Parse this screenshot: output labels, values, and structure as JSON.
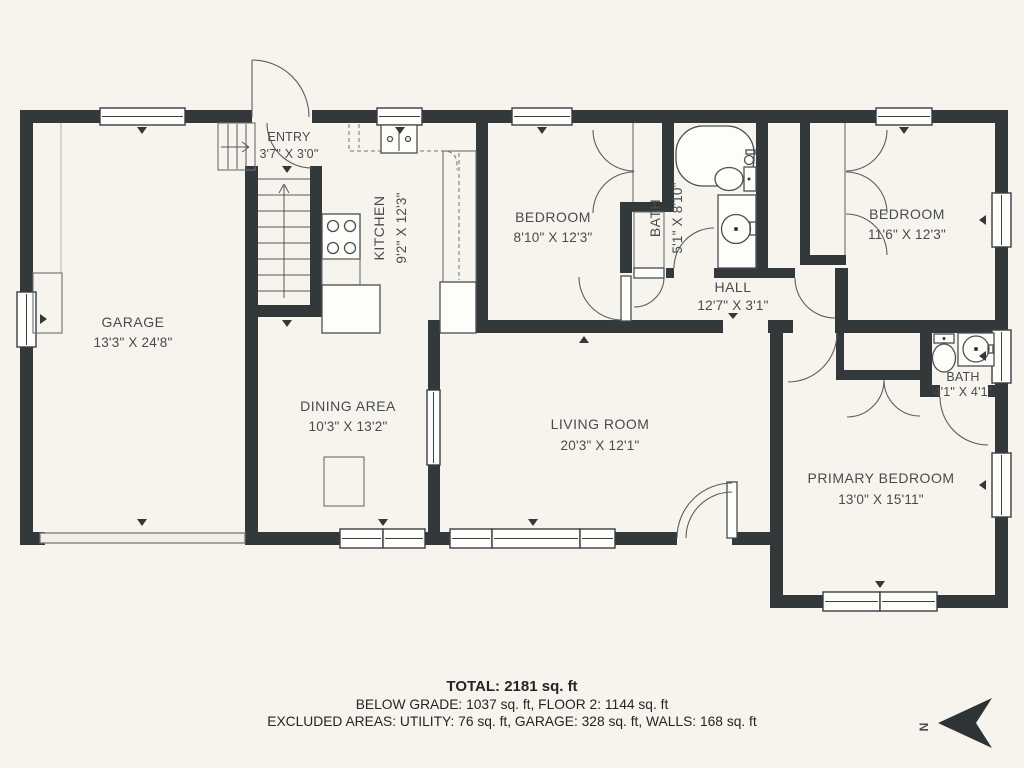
{
  "rooms": [
    {
      "id": "garage",
      "name": "GARAGE",
      "dims": "13'3\" X 24'8\""
    },
    {
      "id": "entry",
      "name": "ENTRY",
      "dims": "3'7\" X 3'0\""
    },
    {
      "id": "kitchen",
      "name": "KITCHEN",
      "dims": "9'2\" X 12'3\""
    },
    {
      "id": "bedroom1",
      "name": "BEDROOM",
      "dims": "8'10\" X 12'3\""
    },
    {
      "id": "bath1",
      "name": "BATH",
      "dims": "5'1\" X 8'10\""
    },
    {
      "id": "bedroom2",
      "name": "BEDROOM",
      "dims": "11'6\" X 12'3\""
    },
    {
      "id": "hall",
      "name": "HALL",
      "dims": "12'7\" X 3'1\""
    },
    {
      "id": "dining",
      "name": "DINING AREA",
      "dims": "10'3\" X 13'2\""
    },
    {
      "id": "living",
      "name": "LIVING ROOM",
      "dims": "20'3\" X 12'1\""
    },
    {
      "id": "bath2",
      "name": "BATH",
      "dims": "4'1\" X 4'1\""
    },
    {
      "id": "primary",
      "name": "PRIMARY BEDROOM",
      "dims": "13'0\" X 15'11\""
    }
  ],
  "footer": {
    "total": "TOTAL: 2181 sq. ft",
    "line2": "BELOW GRADE: 1037 sq. ft, FLOOR 2: 1144 sq. ft",
    "line3": "EXCLUDED AREAS: UTILITY: 76 sq. ft, GARAGE: 328 sq. ft, WALLS: 168 sq. ft"
  },
  "compass": {
    "label": "N"
  },
  "colors": {
    "background": "#f6f4ed",
    "wall": "#33383b",
    "window": "#fdfdfa",
    "text": "#474b4e"
  }
}
